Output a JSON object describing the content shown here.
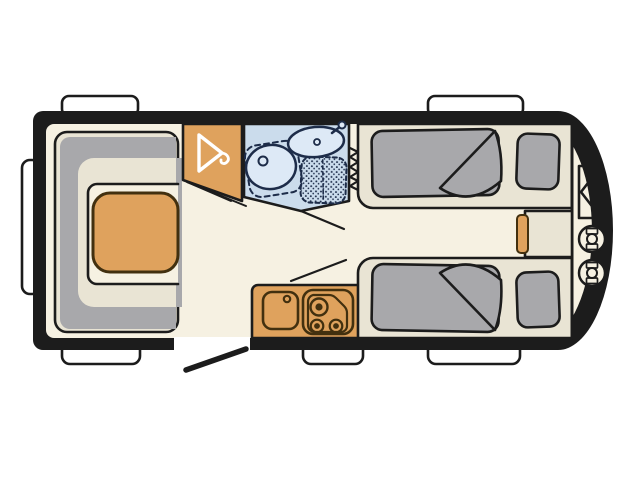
{
  "floorplan": {
    "type": "caravan-floor-plan",
    "style": "hand-drawn top-view schematic, front end (rounded) at right",
    "rooms": [
      {
        "name": "lounge-dinette",
        "position": "rear-left",
        "fixtures": [
          "u-shaped-sofa",
          "sofa-backrest-band",
          "dinette-table"
        ]
      },
      {
        "name": "wardrobe",
        "position": "top-center-left",
        "fixtures": [
          "clothes-hanger-icon",
          "door-swing-lines"
        ]
      },
      {
        "name": "washroom",
        "position": "top-center",
        "fixtures": [
          "washbasin",
          "tap",
          "swivel-toilet",
          "shower-tray",
          "concertina-door"
        ]
      },
      {
        "name": "kitchen",
        "position": "bottom-center",
        "fixtures": [
          "worktop",
          "sink",
          "sink-tap",
          "three-burner-hob"
        ]
      },
      {
        "name": "twin-bedroom",
        "position": "front-right",
        "fixtures": [
          "single-bed-top",
          "single-bed-bottom",
          "mattress-with-folded-corner",
          "pillow",
          "bedside-cabinet",
          "cabinet-orange-front"
        ]
      },
      {
        "name": "front-locker",
        "position": "far-right",
        "fixtures": [
          "locker-door-symbol",
          "gas-bottle",
          "gas-bottle"
        ]
      }
    ],
    "openings": {
      "window_count": 6,
      "windows": [
        "top-left",
        "top-right",
        "side-left",
        "bottom-left",
        "bottom-kitchen",
        "bottom-right"
      ],
      "entry_door": {
        "position": "bottom wall between dinette and kitchen",
        "state": "shown open, leaf drawn outside"
      }
    },
    "colors": {
      "background": "#ffffff",
      "wall_ink": "#1c1c1c",
      "floor_cream": "#f6f1e2",
      "furniture_cream": "#e9e4d4",
      "upholstery_gray": "#a8a8ab",
      "furniture_orange": "#dfa25d",
      "counter_outline": "#42300f",
      "washroom_blue": "#cbdcec",
      "fixture_blue": "#dde9f6",
      "washroom_outline": "#1d2c49",
      "window_white": "#ffffff"
    }
  }
}
